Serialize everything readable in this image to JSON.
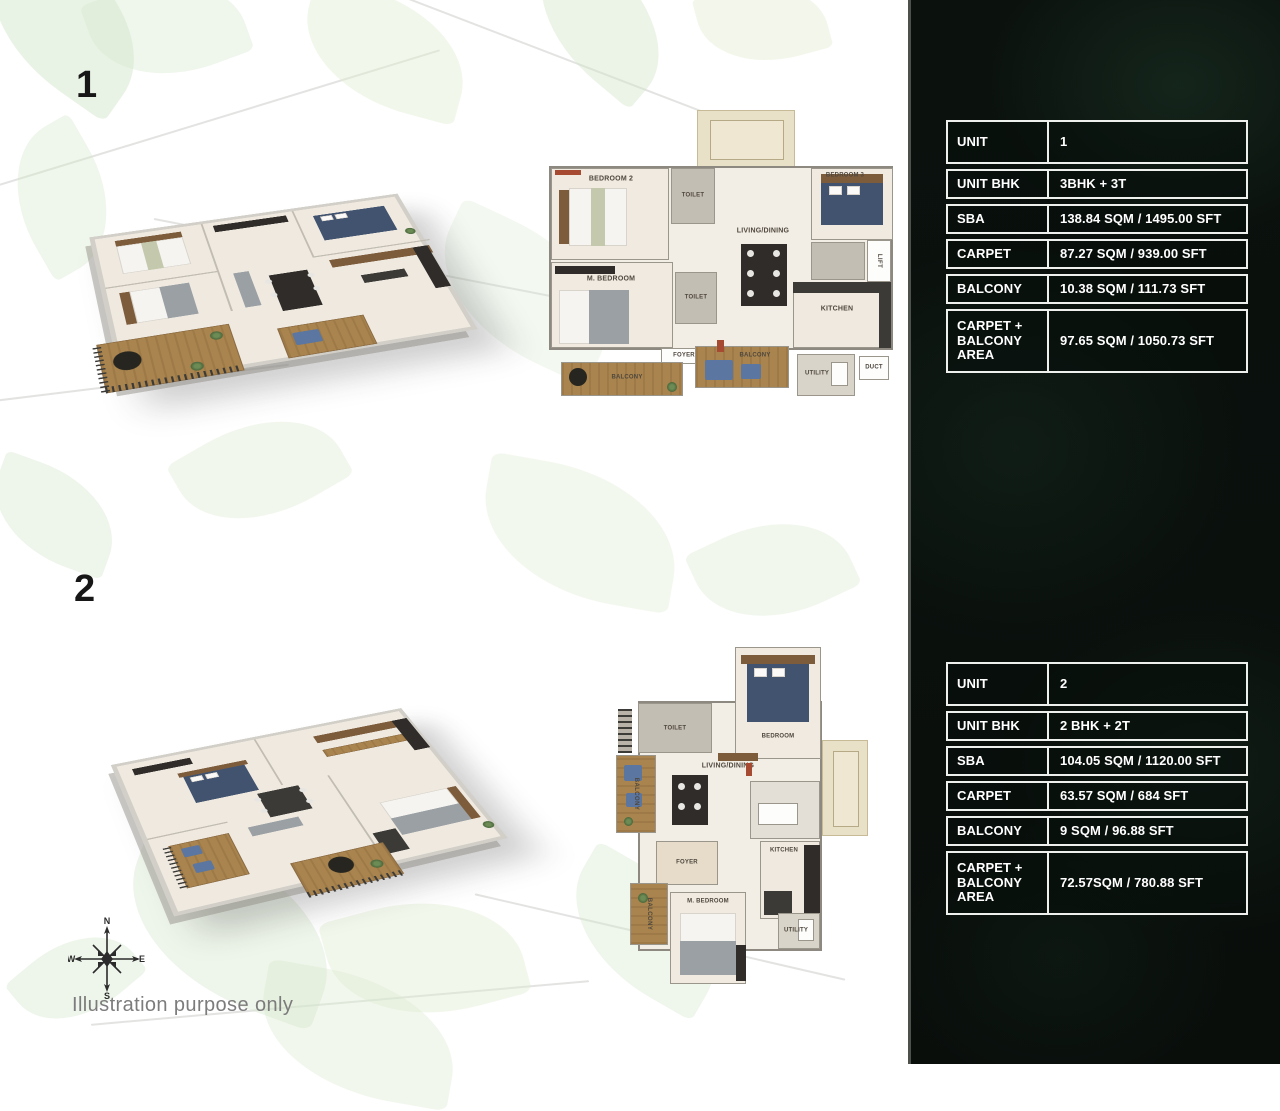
{
  "page": {
    "footnote": "Illustration purpose only"
  },
  "sections": [
    {
      "number": "1"
    },
    {
      "number": "2"
    }
  ],
  "compass": {
    "north": "N",
    "east": "E",
    "south": "S",
    "west": "W"
  },
  "colors": {
    "panel_bg": "#0b120e",
    "table_border": "#eef0ee",
    "leaf": "#cbe2c1",
    "wood_deck": "#a9844e",
    "terrace_beige": "#e9e0c8",
    "bed_blue": "#41536f"
  },
  "tables": [
    {
      "rows": [
        {
          "label": "UNIT",
          "value": "1"
        },
        {
          "label": "UNIT BHK",
          "value": "3BHK + 3T"
        },
        {
          "label": "SBA",
          "value": "138.84 SQM / 1495.00 SFT"
        },
        {
          "label": "CARPET",
          "value": "87.27 SQM / 939.00 SFT"
        },
        {
          "label": "BALCONY",
          "value": "10.38 SQM / 111.73 SFT"
        },
        {
          "label": "CARPET + BALCONY AREA",
          "value": "97.65 SQM / 1050.73 SFT"
        }
      ]
    },
    {
      "rows": [
        {
          "label": "UNIT",
          "value": "2"
        },
        {
          "label": "UNIT BHK",
          "value": "2 BHK + 2T"
        },
        {
          "label": "SBA",
          "value": "104.05 SQM / 1120.00 SFT"
        },
        {
          "label": "CARPET",
          "value": "63.57 SQM / 684 SFT"
        },
        {
          "label": "BALCONY",
          "value": "9 SQM / 96.88 SFT"
        },
        {
          "label": "CARPET + BALCONY AREA",
          "value": "72.57SQM / 780.88 SFT"
        }
      ]
    }
  ],
  "plan1": {
    "bedroom2": "BEDROOM 2",
    "toilet1": "TOILET",
    "living": "LIVING/DINING",
    "bedroom3": "BEDROOM 3",
    "lift": "LIFT",
    "duct": "DUCT",
    "kitchen": "KITCHEN",
    "master": "M. BEDROOM",
    "toilet2": "TOILET",
    "balcony1": "BALCONY",
    "balcony2": "BALCONY",
    "utility": "UTILITY",
    "foyer": "FOYER"
  },
  "plan2": {
    "toilet": "TOILET",
    "bedroom": "BEDROOM",
    "living": "LIVING/DINING",
    "balcony1": "BALCONY",
    "foyer": "FOYER",
    "kitchen": "KITCHEN",
    "master": "M. BEDROOM",
    "balcony2": "BALCONY",
    "utility": "UTILITY"
  }
}
